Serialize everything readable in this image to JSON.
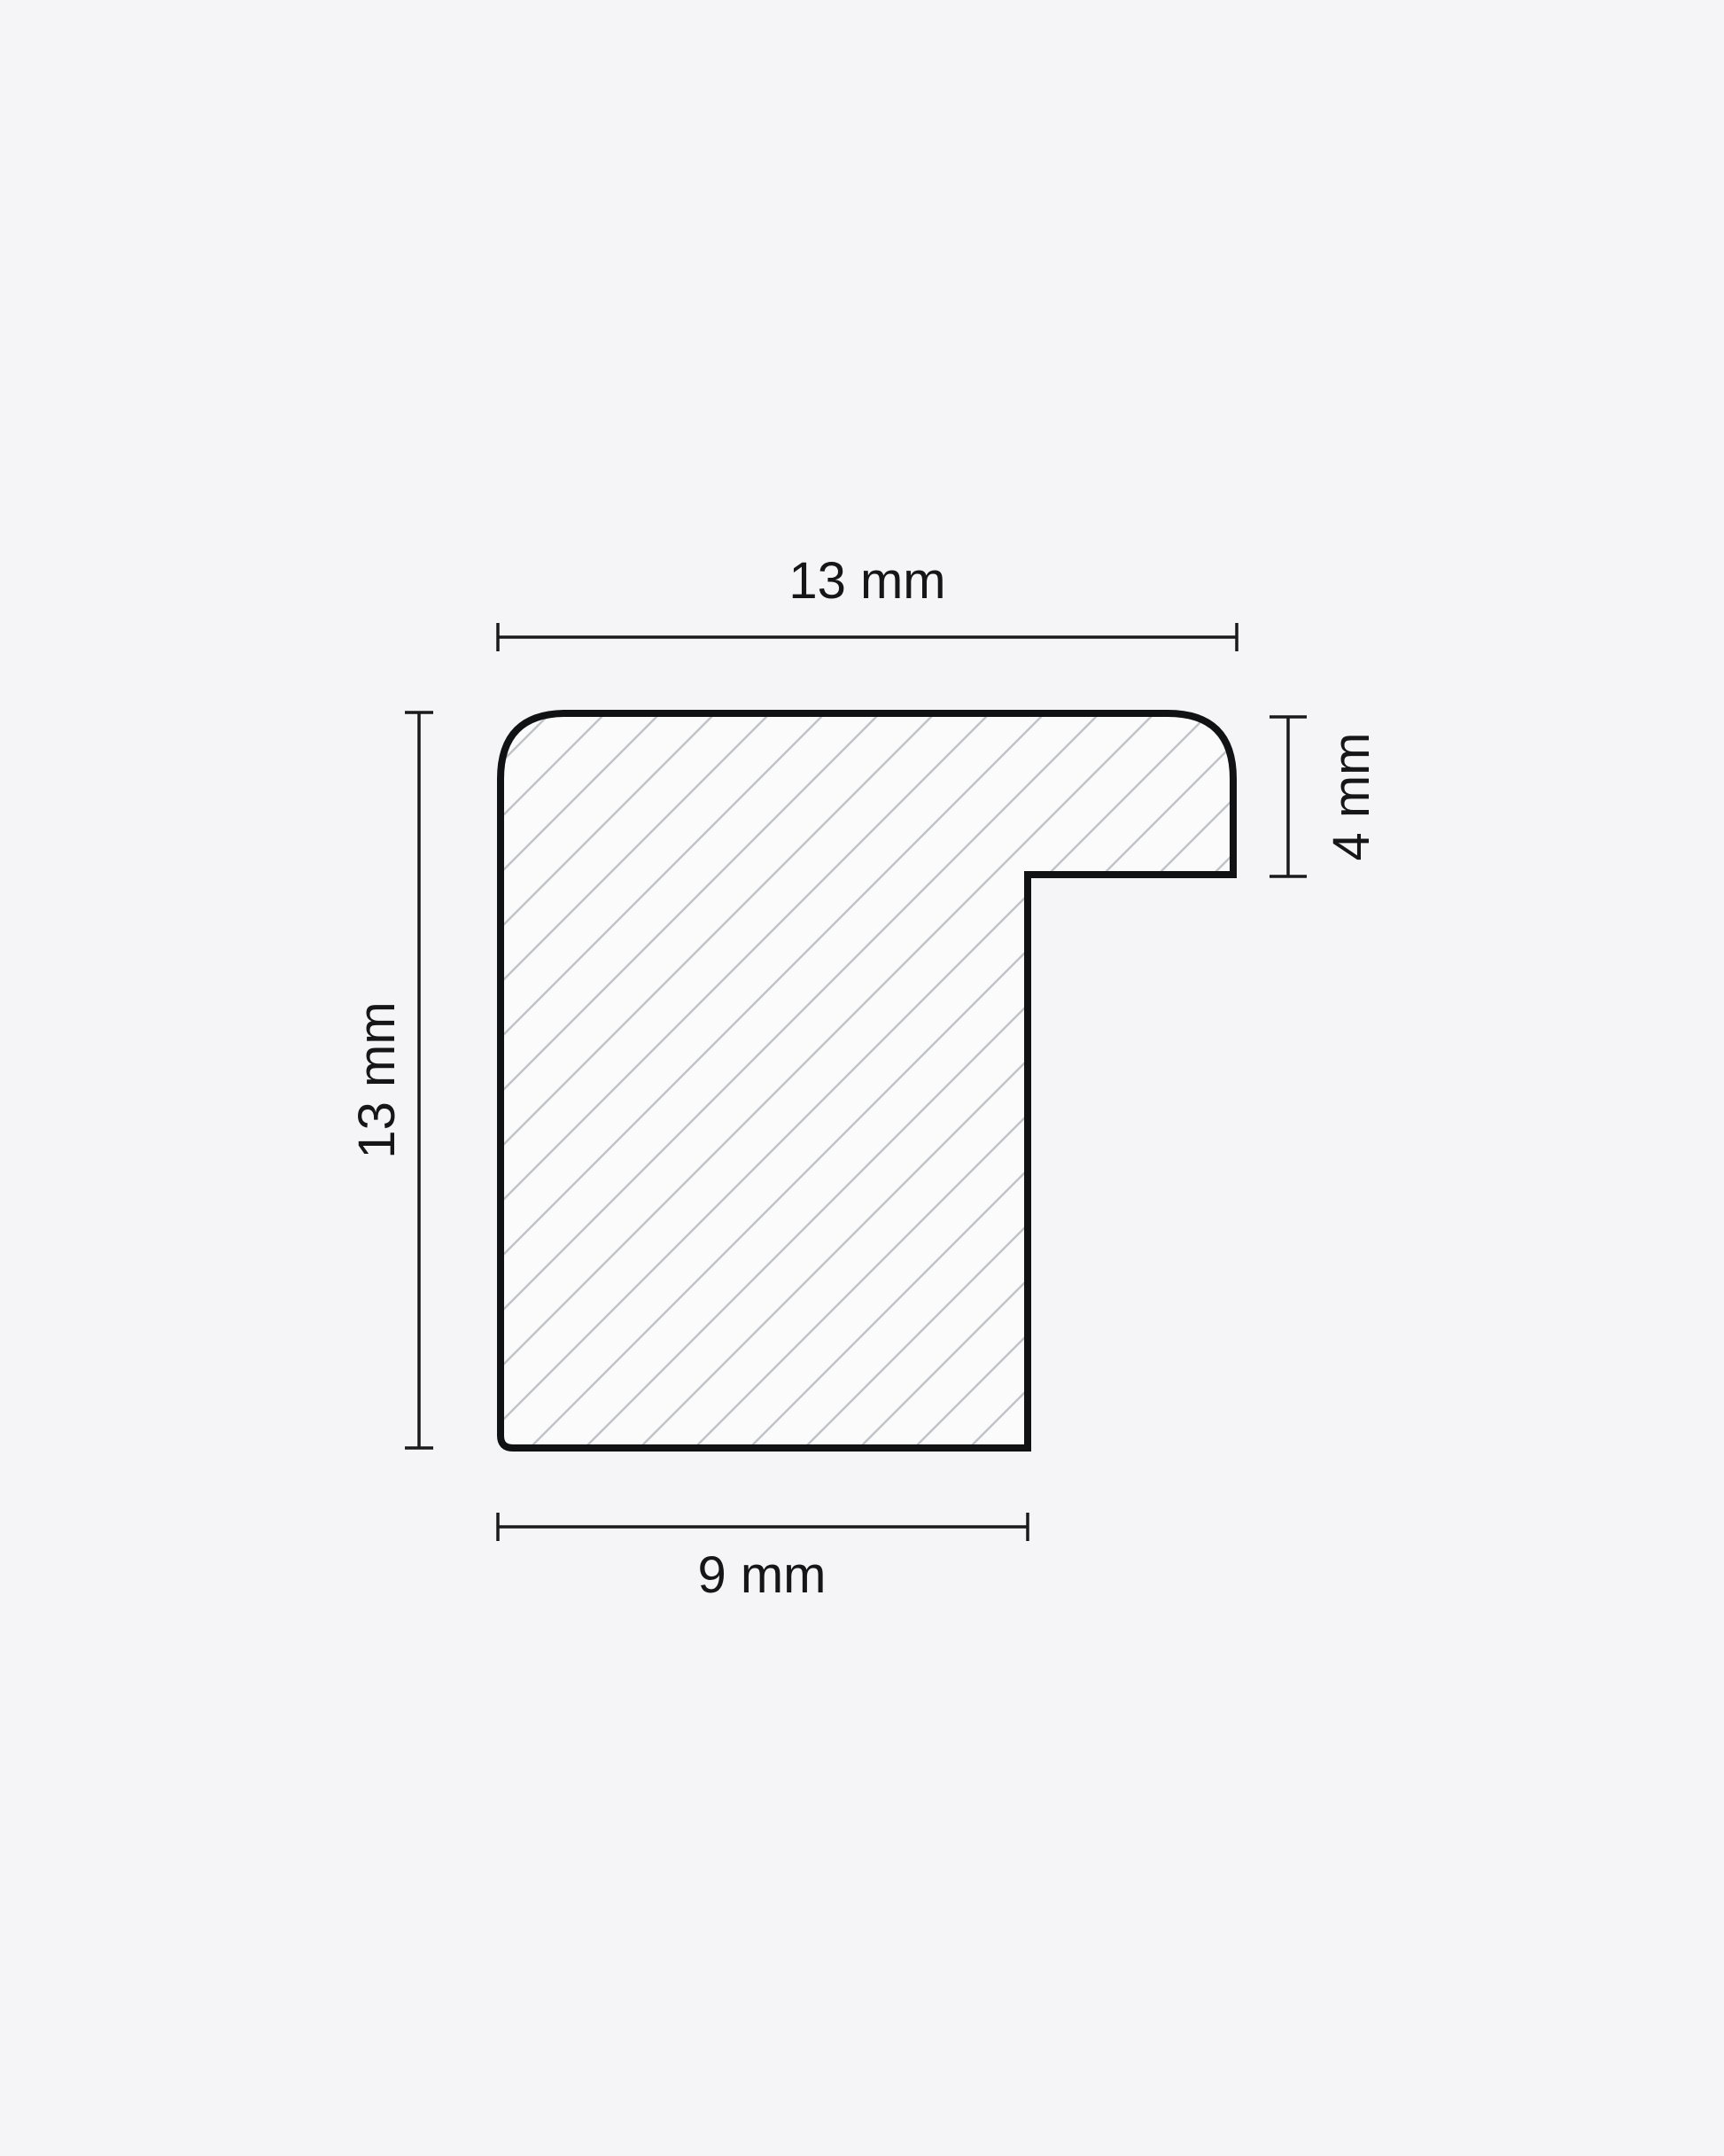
{
  "diagram": {
    "name": "frame-moulding-profile-cross-section",
    "description": "Technical cross-section of a frame moulding profile with diagonal hatching and four dimension callouts",
    "dimensions": {
      "top_width": "13 mm",
      "left_height": "13 mm",
      "right_lip_height": "4 mm",
      "bottom_width": "9 mm"
    },
    "colors": {
      "background": "#f5f5f7",
      "shape_fill": "#fbfbfc",
      "hatch_line": "#c0c3c7",
      "outline": "#111213",
      "dimension_line": "#1a1a1c",
      "label_text": "#161618"
    }
  }
}
